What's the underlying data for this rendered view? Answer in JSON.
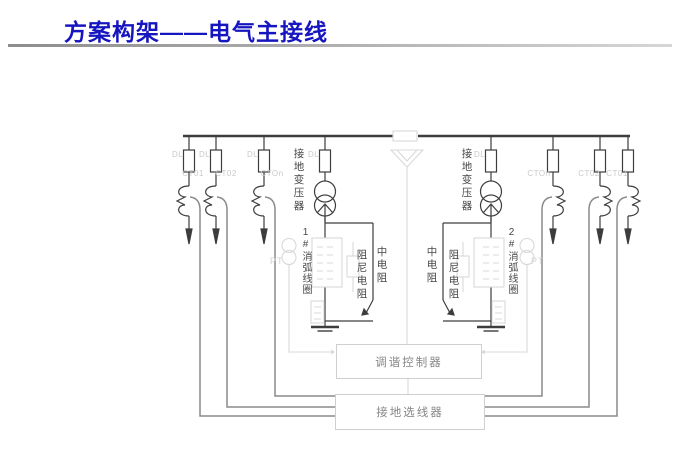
{
  "slide": {
    "title": "方案构架——电气主接线"
  },
  "colors": {
    "title_blue": "#1616c0",
    "diagram_dark": "#3d3d3d",
    "signal_gray": "#8a8a8a",
    "light_gray": "#d9d9d9",
    "faint_label": "#c9c9c9",
    "box_text_gray": "#868686"
  },
  "diagram": {
    "feeders": {
      "left": [
        {
          "breaker": "DL",
          "ct": "CT01"
        },
        {
          "breaker": "DL",
          "ct": "CT02"
        },
        {
          "breaker": "DL",
          "ct": "CTOn"
        }
      ],
      "right": [
        {
          "ct": "CTOn"
        },
        {
          "ct": "CT02"
        },
        {
          "ct": "CT01"
        }
      ]
    },
    "grounding_transformer_left": {
      "breaker": "DL",
      "label": "接地变压器"
    },
    "grounding_transformer_right": {
      "breaker": "DL",
      "label": "接地变压器"
    },
    "arc_suppression_coil_left": {
      "label": "1#消弧线圈"
    },
    "arc_suppression_coil_right": {
      "label": "2#消弧线圈"
    },
    "damping_resistor_left": {
      "label": "阻尼电阻"
    },
    "damping_resistor_right": {
      "label": "阻尼电阻"
    },
    "medium_resistor_left": {
      "label": "中电阻"
    },
    "medium_resistor_right": {
      "label": "中电阻"
    },
    "pt_left": {
      "label": "PT"
    },
    "pt_right": {
      "label": "PT"
    },
    "tuning_controller": {
      "label": "调谐控制器"
    },
    "ground_line_selector": {
      "label": "接地选线器"
    }
  }
}
